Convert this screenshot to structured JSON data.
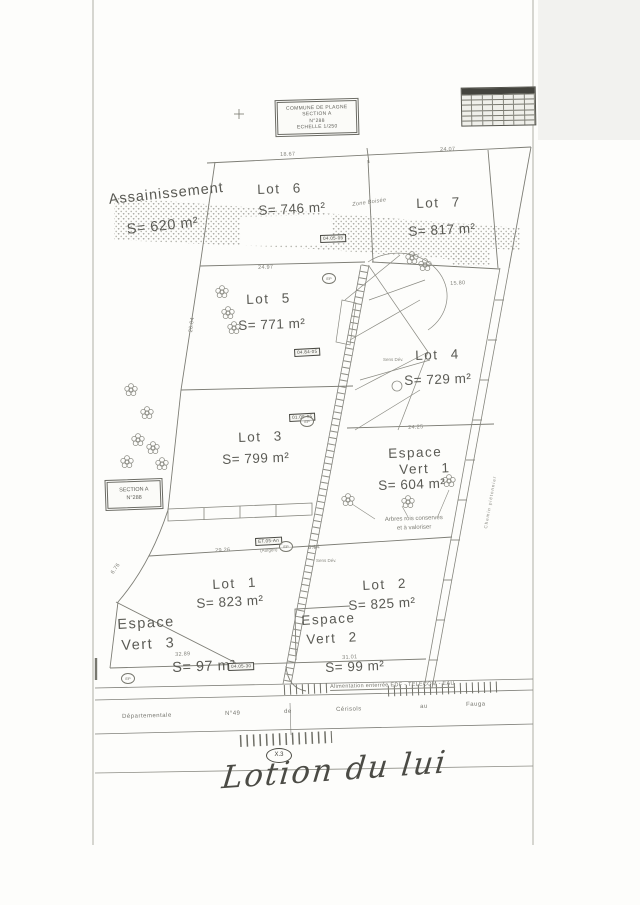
{
  "title_block": {
    "line1": "COMMUNE DE PLAGNE",
    "line2": "SECTION A",
    "line3": "N°288",
    "line4": "ECHELLE 1/250"
  },
  "section_box": {
    "line1": "SECTION A",
    "line2": "N°288"
  },
  "parcels": {
    "assainissement": {
      "name": "Assainissement",
      "area": "S= 620 m²"
    },
    "lot6": {
      "name": "Lot 6",
      "area": "S= 746 m²"
    },
    "lot7": {
      "name": "Lot 7",
      "area": "S= 817 m²"
    },
    "lot5": {
      "name": "Lot 5",
      "area": "S= 771 m²"
    },
    "lot4": {
      "name": "Lot 4",
      "area": "S= 729 m²"
    },
    "lot3": {
      "name": "Lot 3",
      "area": "S= 799 m²"
    },
    "lot1": {
      "name": "Lot 1",
      "area": "S= 823 m²"
    },
    "lot2": {
      "name": "Lot 2",
      "area": "S= 825 m²"
    },
    "espace_vert_1": {
      "name1": "Espace",
      "name2": "Vert 1",
      "area": "S= 604 m²"
    },
    "espace_vert_2": {
      "name1": "Espace",
      "name2": "Vert 2",
      "area": "S= 99 m²"
    },
    "espace_vert_3": {
      "name1": "Espace",
      "name2": "Vert 3",
      "area": "S= 97 m²"
    }
  },
  "annotations": {
    "zone_boisee": "Zone Boisée",
    "arbres_line1": "Arbres rois conservés",
    "arbres_line2": "et à valoriser",
    "chemin": "Chemin piétonnier",
    "alimentation": "Alimentation enterrée EDF - TELECOM - EAU",
    "sens_dev": "Sens Dév.",
    "x3": "X.3",
    "handwriting": "Lotion du lui"
  },
  "road": {
    "w1": "Départementale",
    "w2": "N°49",
    "w3": "de",
    "w4": "Cérisols",
    "w5": "au",
    "w6": "Fauga"
  },
  "dimensions": {
    "d1": "18.67",
    "d2": "24.07",
    "d3": "24.97",
    "d4": "15.80",
    "d5": "24.25",
    "d6": "29.26",
    "d7": "8.14",
    "d8": "32.89",
    "d9": "31.01",
    "d10": "26.04",
    "d11": "6.76"
  },
  "markers": {
    "ep": "EP",
    "b1": "04.05-05",
    "b2": "04.84-05",
    "b3": "01.05-05",
    "b4": "ET.05-An",
    "b4b": "(Aufgeri)",
    "b5": "04.05-30"
  }
}
